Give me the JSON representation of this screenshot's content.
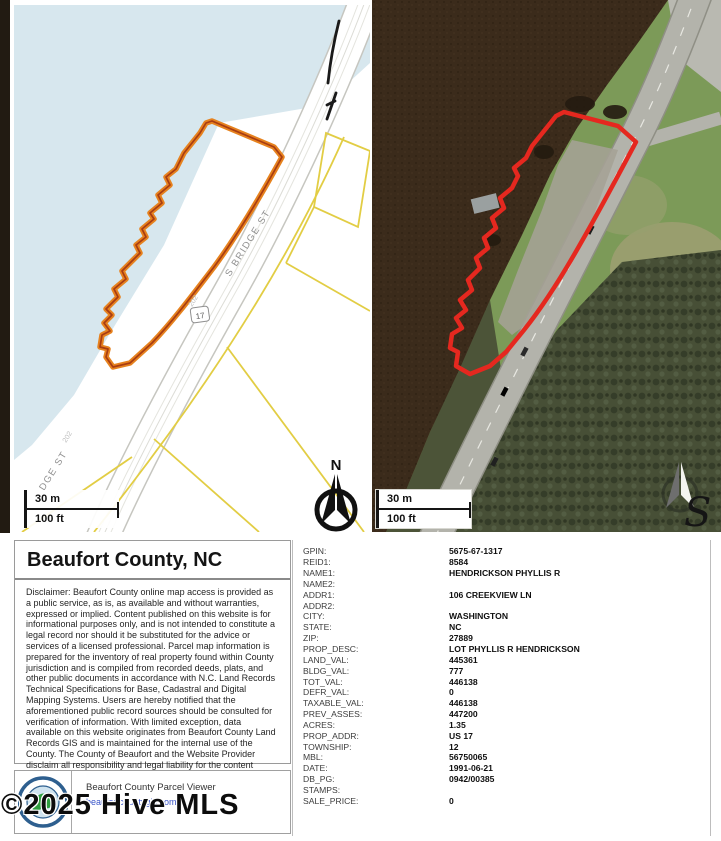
{
  "watermark": {
    "text": "©2025 Hive MLS",
    "signature_glyph": "S"
  },
  "map_left": {
    "street_label": "S BRIDGE ST",
    "street_label_partial": "DGE ST",
    "road_frontage_label": "202",
    "route_shield": "17",
    "north_label": "N",
    "scale_meters": "30 m",
    "scale_feet": "100 ft",
    "water_color": "#d7e7ee",
    "parcel_line_color": "#e2cd44",
    "highlight_outline_color": "#e6821e"
  },
  "map_right": {
    "scale_meters": "30 m",
    "scale_feet": "100 ft",
    "parcel_outline_color": "#e5281f"
  },
  "info_panel": {
    "title": "Beaufort County, NC",
    "disclaimer": "Disclaimer: Beaufort County online map access is provided as a public service, as is, as available and without warranties, expressed or implied. Content published on this website is for informational purposes only, and is not intended to constitute a legal record nor should it be substituted for the advice or services of a licensed professional. Parcel map information is prepared for the inventory of real property found within County jurisdiction and is compiled from recorded deeds, plats, and other public documents in accordance with N.C. Land Records Technical Specifications for Base, Cadastral and Digital Mapping Systems. Users are hereby notified that the aforementioned public record sources should be consulted for verification of information. With limited exception, data available on this website originates from Beaufort County Land Records GIS and is maintained for the internal use of the County. The County of Beaufort and the Website Provider disclaim all responsibility and legal liability for the content published on this website.",
    "viewer_name": "Beaufort County Parcel Viewer",
    "viewer_url": "beaufortcountygis.com"
  },
  "attributes": [
    {
      "label": "GPIN:",
      "value": "5675-67-1317"
    },
    {
      "label": "REID1:",
      "value": "8584"
    },
    {
      "label": "NAME1:",
      "value": "HENDRICKSON PHYLLIS R"
    },
    {
      "label": "NAME2:",
      "value": ""
    },
    {
      "label": "ADDR1:",
      "value": "106 CREEKVIEW LN"
    },
    {
      "label": "ADDR2:",
      "value": ""
    },
    {
      "label": "CITY:",
      "value": "WASHINGTON"
    },
    {
      "label": "STATE:",
      "value": "NC"
    },
    {
      "label": "ZIP:",
      "value": "27889"
    },
    {
      "label": "PROP_DESC:",
      "value": "LOT PHYLLIS R HENDRICKSON"
    },
    {
      "label": "LAND_VAL:",
      "value": "445361"
    },
    {
      "label": "BLDG_VAL:",
      "value": "777"
    },
    {
      "label": "TOT_VAL:",
      "value": "446138"
    },
    {
      "label": "DEFR_VAL:",
      "value": "0"
    },
    {
      "label": "TAXABLE_VAL:",
      "value": "446138"
    },
    {
      "label": "PREV_ASSES:",
      "value": "447200"
    },
    {
      "label": "ACRES:",
      "value": "1.35"
    },
    {
      "label": "PROP_ADDR:",
      "value": "US 17"
    },
    {
      "label": "TOWNSHIP:",
      "value": "12"
    },
    {
      "label": "MBL:",
      "value": "56750065"
    },
    {
      "label": "DATE:",
      "value": "1991-06-21"
    },
    {
      "label": "DB_PG:",
      "value": "0942/00385"
    },
    {
      "label": "STAMPS:",
      "value": ""
    },
    {
      "label": "SALE_PRICE:",
      "value": "0"
    }
  ]
}
